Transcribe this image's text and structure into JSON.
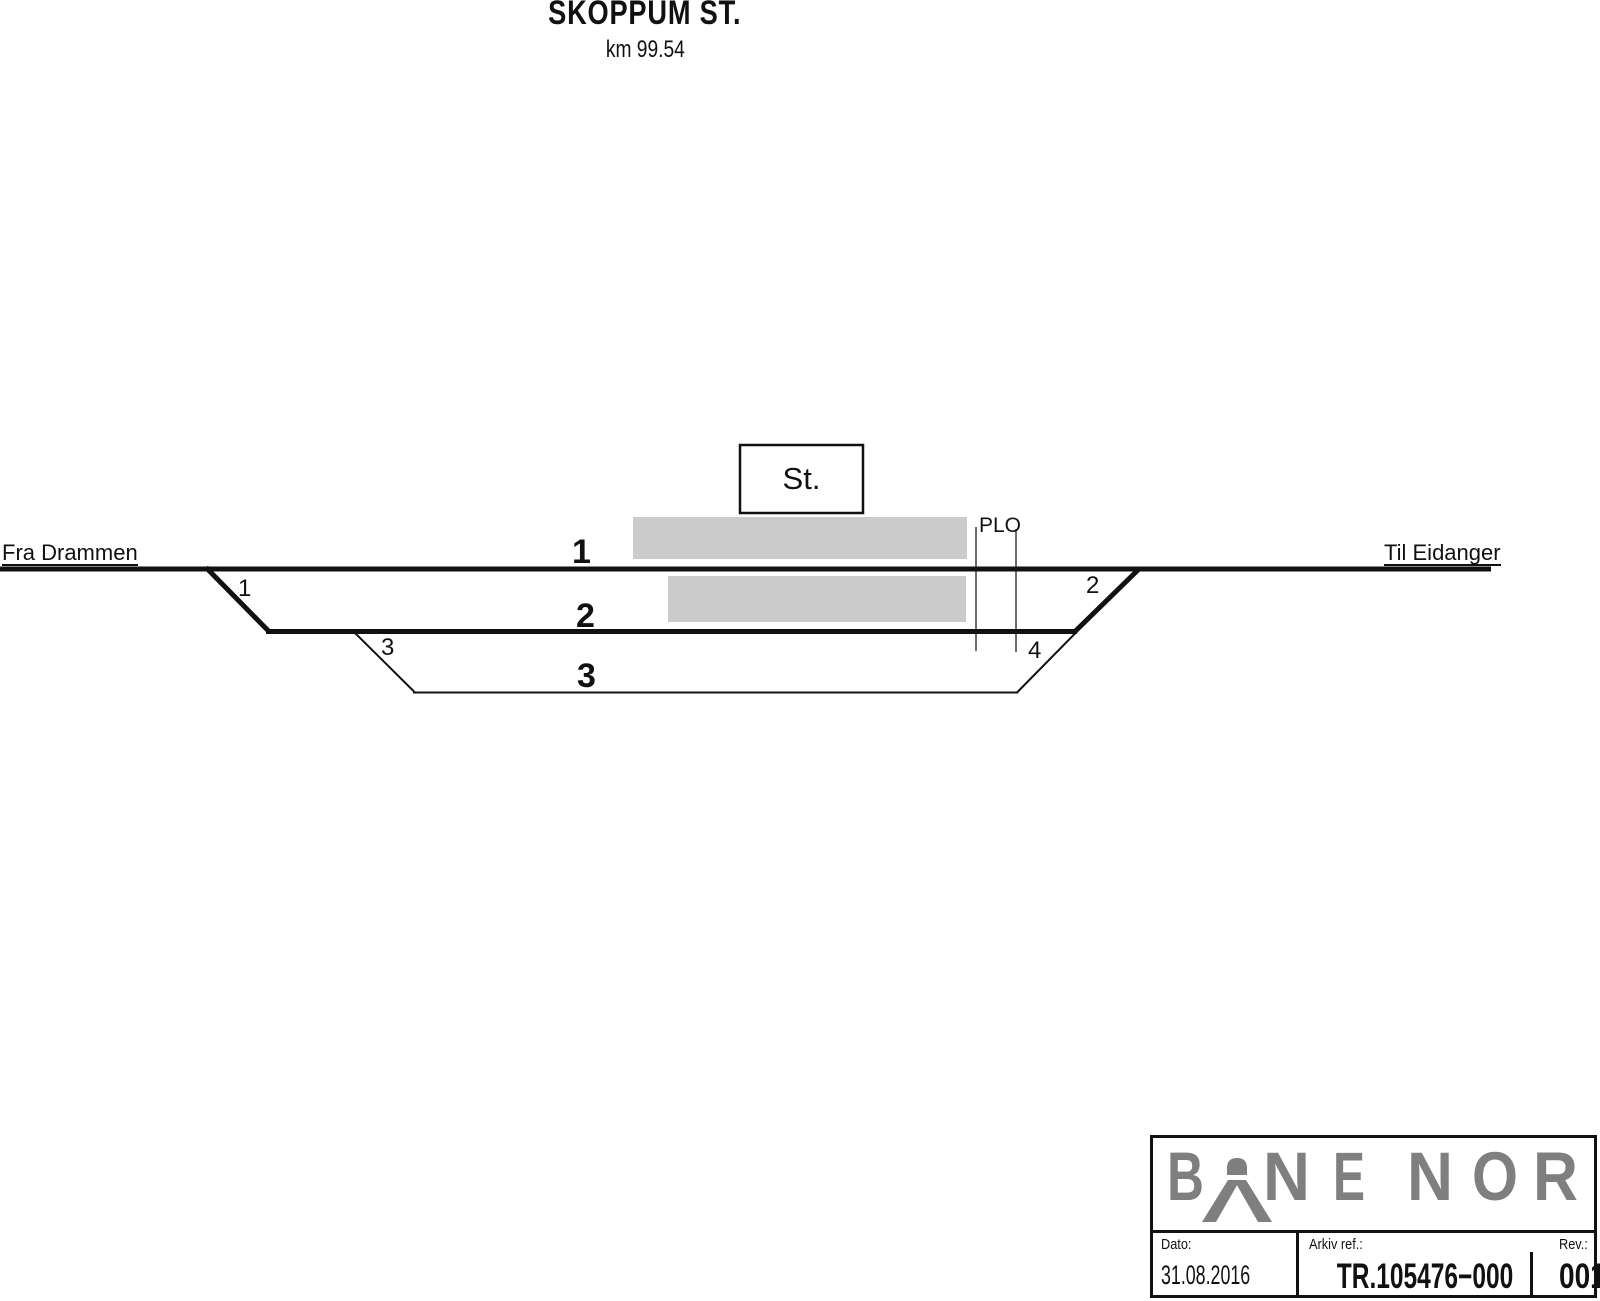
{
  "title": {
    "station": "SKOPPUM ST.",
    "km": "km 99.54"
  },
  "diagram": {
    "from_label": "Fra Drammen",
    "to_label": "Til Eidanger",
    "station_box_label": "St.",
    "level_crossing_label": "PLO",
    "track_numbers": [
      "1",
      "2",
      "3"
    ],
    "switch_numbers": [
      "1",
      "2",
      "3",
      "4"
    ],
    "colors": {
      "line": "#111111",
      "platform": "#cbcbcb",
      "plo_line": "#3c3c3c"
    }
  },
  "title_block": {
    "logo": {
      "alt": "BANE NOR",
      "color": "#7f7f7f",
      "letters": [
        "B",
        "N",
        "E",
        "N",
        "O",
        "R"
      ]
    },
    "date_label": "Dato:",
    "date_value": "31.08.2016",
    "ref_label": "Arkiv ref.:",
    "ref_value": "TR.105476−000",
    "rev_label": "Rev.:",
    "rev_value": "001"
  }
}
